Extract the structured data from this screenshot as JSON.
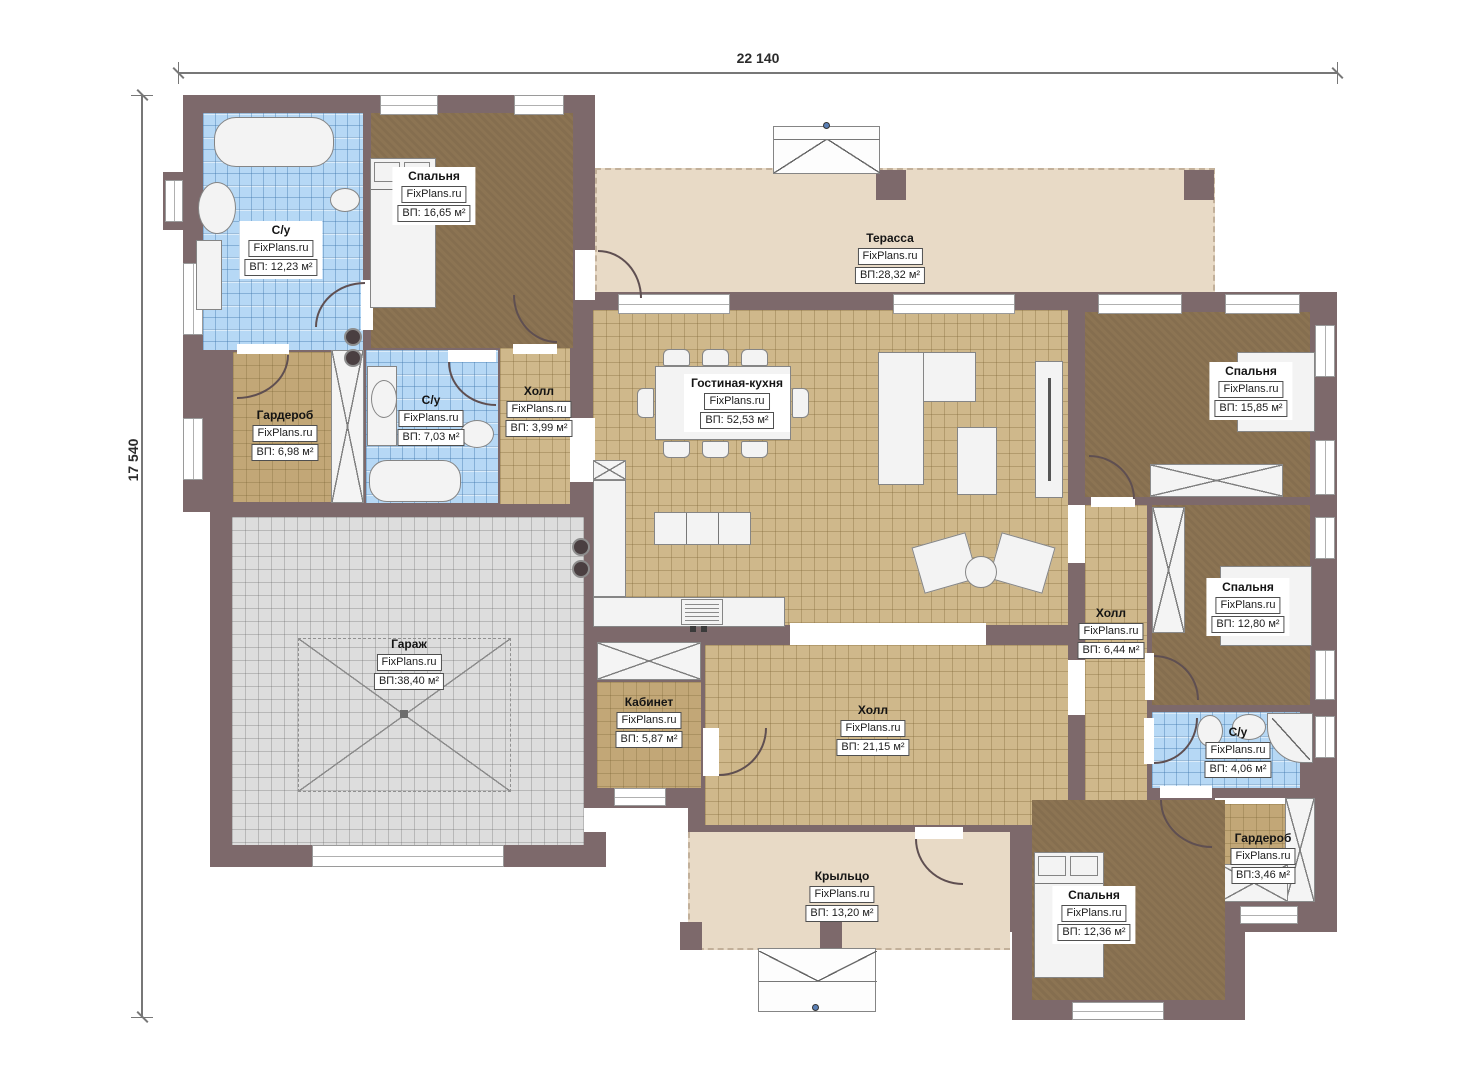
{
  "watermark": "FixPlans.ru",
  "dimensions": {
    "width_label": "22 140",
    "height_label": "17 540"
  },
  "colors": {
    "wall": "#7d696b",
    "floor_wood_dark": "#8c7453",
    "floor_tile_tan": "#cfb88b",
    "floor_tile_blue": "#b6d8f5",
    "floor_garage": "#dddddd",
    "terrace": "#e8dac6"
  },
  "rooms": [
    {
      "id": "bath-1",
      "name": "С/у",
      "area": "ВП: 12,23 м²"
    },
    {
      "id": "bedroom-1",
      "name": "Спальня",
      "area": "ВП: 16,65 м²"
    },
    {
      "id": "terrace",
      "name": "Терасса",
      "area": "ВП:28,32 м²"
    },
    {
      "id": "wardrobe-1",
      "name": "Гардероб",
      "area": "ВП: 6,98 м²"
    },
    {
      "id": "bath-2",
      "name": "С/у",
      "area": "ВП: 7,03 м²"
    },
    {
      "id": "hall-1",
      "name": "Холл",
      "area": "ВП: 3,99 м²"
    },
    {
      "id": "living-kitchen",
      "name": "Гостиная-кухня",
      "area": "ВП: 52,53 м²"
    },
    {
      "id": "bedroom-2",
      "name": "Спальня",
      "area": "ВП: 15,85 м²"
    },
    {
      "id": "hall-2",
      "name": "Холл",
      "area": "ВП: 6,44 м²"
    },
    {
      "id": "bedroom-3",
      "name": "Спальня",
      "area": "ВП: 12,80 м²"
    },
    {
      "id": "garage",
      "name": "Гараж",
      "area": "ВП:38,40 м²"
    },
    {
      "id": "cabinet",
      "name": "Кабинет",
      "area": "ВП: 5,87 м²"
    },
    {
      "id": "hall-3",
      "name": "Холл",
      "area": "ВП: 21,15 м²"
    },
    {
      "id": "bath-3",
      "name": "С/у",
      "area": "ВП: 4,06 м²"
    },
    {
      "id": "wardrobe-2",
      "name": "Гардероб",
      "area": "ВП:3,46 м²"
    },
    {
      "id": "bedroom-4",
      "name": "Спальня",
      "area": "ВП: 12,36 м²"
    },
    {
      "id": "porch",
      "name": "Крыльцо",
      "area": "ВП: 13,20 м²"
    }
  ]
}
